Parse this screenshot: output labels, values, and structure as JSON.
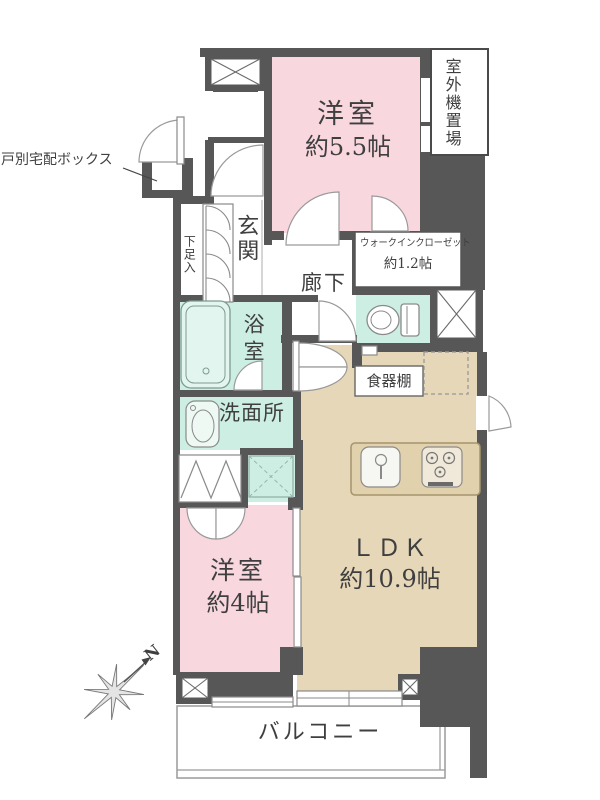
{
  "colors": {
    "wall": "#575757",
    "room_pink": "#f8d7de",
    "wet_mint": "#cdeee3",
    "ldk_beige": "#e6d7b8",
    "counter_tan": "#e2d1ad",
    "text_ink": "#3f3f3f"
  },
  "rooms": {
    "bedroom_main": {
      "name": "洋室",
      "size": "約5.5帖"
    },
    "walk_in_closet": {
      "name": "ウォークインクローゼット",
      "size": "約1.2帖"
    },
    "outdoor_unit_space": {
      "name": "室外機置場"
    },
    "entrance": {
      "name": "玄関"
    },
    "hallway": {
      "name": "廊下"
    },
    "bathroom": {
      "name": "浴室"
    },
    "washroom": {
      "name": "洗面所"
    },
    "ldk": {
      "name": "ＬＤＫ",
      "size": "約10.9帖"
    },
    "bedroom_second": {
      "name": "洋室",
      "size": "約4帖"
    },
    "balcony": {
      "name": "バルコニー"
    }
  },
  "annotations": {
    "delivery_box": "戸別宅配ボックス",
    "shoe_cabinet": "下足入",
    "cupboard": "食器棚",
    "compass_north": "N"
  }
}
